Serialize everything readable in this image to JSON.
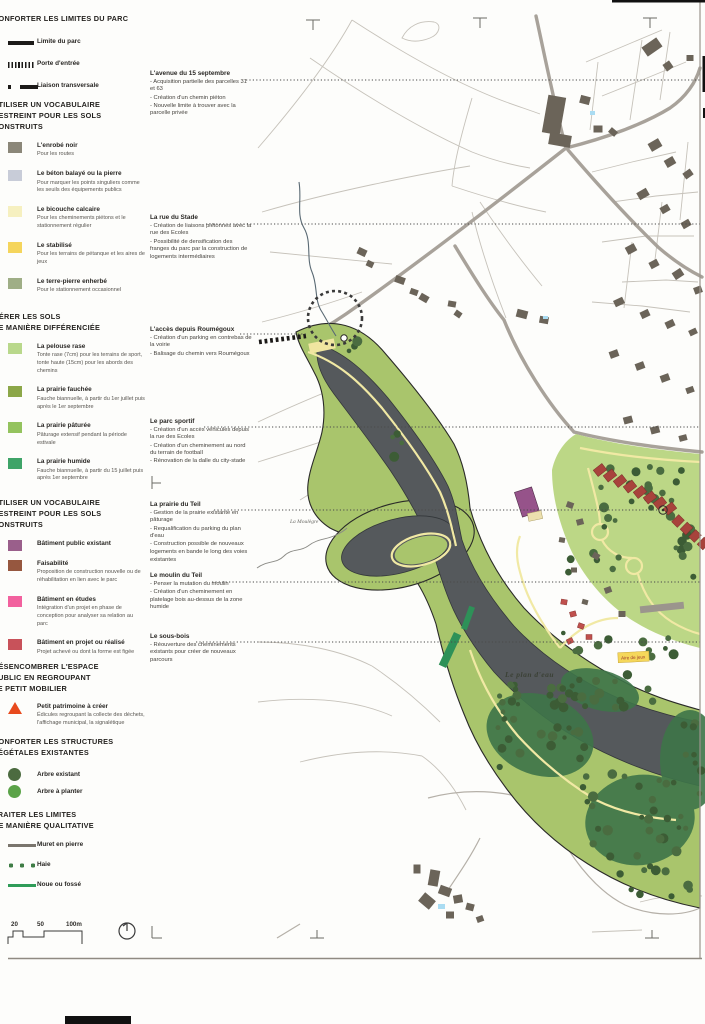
{
  "legend": {
    "sections": [
      {
        "title": "CONFORTER LES LIMITES DU PARC",
        "items": [
          {
            "label": "Limite du parc"
          },
          {
            "label": "Porte d'entrée"
          },
          {
            "label": "Liaison transversale"
          }
        ]
      },
      {
        "title": "UTILISER UN VOCABULAIRE\nRESTREINT POUR LES SOLS\nCONSTRUITS",
        "items": [
          {
            "label": "L'enrobé noir",
            "desc": "Pour les routes",
            "color": "#8b8779"
          },
          {
            "label": "Le béton balayé ou la pierre",
            "desc": "Pour marquer les points singuliers comme les seuils des équipements publics",
            "color": "#c8ccd8"
          },
          {
            "label": "Le bicouche calcaire",
            "desc": "Pour les cheminements piétons et le stationnement régulier",
            "color": "#f6f0c0"
          },
          {
            "label": "Le stabilisé",
            "desc": "Pour les terrains de pétanque et les aires de jeux",
            "color": "#f5d55c"
          },
          {
            "label": "Le terre-pierre enherbé",
            "desc": "Pour le stationnement occasionnel",
            "color": "#9fae86"
          }
        ]
      },
      {
        "title": "GÉRER LES SOLS\nDE MANIÈRE DIFFÉRENCIÉE",
        "items": [
          {
            "label": "La pelouse rase",
            "desc": "Tonte rase (7cm) pour les terrains de sport, tonte haute (15cm) pour les abords des chemins",
            "color": "#b9d88b"
          },
          {
            "label": "La prairie fauchée",
            "desc": "Fauche biannuelle, à partir du 1er juillet puis après le 1er septembre",
            "color": "#8ca748"
          },
          {
            "label": "La prairie pâturée",
            "desc": "Pâturage extensif pendant la période estivale",
            "color": "#94c35e"
          },
          {
            "label": "La prairie humide",
            "desc": "Fauche biannuelle, à partir du 15 juillet puis après 1er septembre",
            "color": "#3fa468"
          }
        ]
      },
      {
        "title": "UTILISER UN VOCABULAIRE\nRESTREINT POUR LES SOLS\nCONSTRUITS",
        "items": [
          {
            "label": "Bâtiment public existant",
            "color": "#9a5f8b"
          },
          {
            "label": "Faisabilité",
            "desc": "Proposition de construction nouvelle ou de réhabilitation en lien avec le parc",
            "color": "#96573f"
          },
          {
            "label": "Bâtiment en études",
            "desc": "Intégration d'un projet en phase de conception pour analyser sa relation au parc",
            "color": "#f2619e"
          },
          {
            "label": "Bâtiment en projet ou réalisé",
            "desc": "Projet achevé ou dont la forme est figée",
            "color": "#c8525a"
          }
        ]
      },
      {
        "title": "DÉSENCOMBRER L'ESPACE\nPUBLIC EN REGROUPANT\nLE PETIT MOBILIER",
        "items": [
          {
            "label": "Petit patrimoine à créer",
            "desc": "Édicules regroupant la collecte des déchets, l'affichage municipal, la signalétique",
            "color": "#e84a1d"
          }
        ]
      },
      {
        "title": "CONFORTER LES STRUCTURES\nVÉGÉTALES EXISTANTES",
        "items": [
          {
            "label": "Arbre existant",
            "color": "#4c6b40"
          },
          {
            "label": "Arbre à planter",
            "color": "#5ba348"
          }
        ]
      },
      {
        "title": "TRAITER LES LIMITES\nDE MANIÈRE QUALITATIVE",
        "items": [
          {
            "label": "Muret en pierre",
            "color": "#7a756d"
          },
          {
            "label": "Haie",
            "color": "#3f7d46"
          },
          {
            "label": "Noue ou fossé",
            "color": "#2f9c58"
          }
        ]
      }
    ]
  },
  "annotations": [
    {
      "title": "L'avenue du 15 septembre",
      "bullets": [
        "- Acquisition partielle des parcelles 31 et 63",
        "- Création d'un chemin piéton",
        "- Nouvelle limite à trouver avec la parcelle privée"
      ]
    },
    {
      "title": "La rue du Stade",
      "bullets": [
        "- Création de liaisons piétonnes avec la rue des Ecoles",
        "- Possibilité de densification des franges du parc par la construction de logements intermédiaires"
      ]
    },
    {
      "title": "L'accès depuis Roumégoux",
      "bullets": [
        "- Création d'un parking en contrebas de la voirie",
        "- Balisage du chemin vers Roumégoux"
      ]
    },
    {
      "title": "Le parc sportif",
      "bullets": [
        "- Création d'un accès véhicules depuis la rue des Ecoles",
        "- Création d'un cheminement au nord du terrain de football",
        "- Rénovation de la dalle du city-stade"
      ]
    },
    {
      "title": "La prairie du Teil",
      "bullets": [
        "- Gestion de la prairie existante en pâturage",
        "- Requalification du parking du plan d'eau",
        "- Construction possible de nouveaux logements en bande le long des voies existantes"
      ]
    },
    {
      "title": "Le moulin du Teil",
      "bullets": [
        "- Penser la mutation du moulin",
        "- Création d'un cheminement en platelage bois au-dessus de la zone humide"
      ]
    },
    {
      "title": "Le sous-bois",
      "bullets": [
        "- Réouverture des cheminements existants pour créer de nouveaux parcours"
      ]
    }
  ],
  "map": {
    "labels": {
      "stream": "La Moulègre",
      "water": "Le plan d'eau",
      "playground": "Aire de jeux"
    },
    "colors": {
      "water": "#55595c",
      "park": "#a9c56c",
      "lawn": "#bcd786",
      "woods": "#3e7549",
      "trail": "#f1e9a4",
      "housing_project": "#a8433c",
      "public_building": "#96538a",
      "road": "#a8a29a"
    }
  },
  "scale": {
    "t20": "20",
    "t50": "50",
    "t100": "100m"
  }
}
